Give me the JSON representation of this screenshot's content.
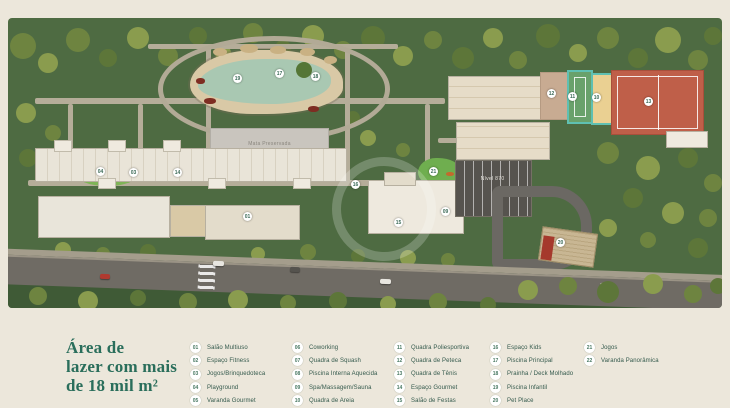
{
  "title": {
    "lines": [
      "Área de",
      "lazer com mais",
      "de 18 mil m²"
    ],
    "color": "#2a6e5b"
  },
  "map": {
    "labels": {
      "preserved_area": "Mata Preservada",
      "level": "Nível 870"
    },
    "markers": [
      {
        "num": "19",
        "x": 229,
        "y": 60
      },
      {
        "num": "17",
        "x": 271,
        "y": 55
      },
      {
        "num": "18",
        "x": 307,
        "y": 58
      },
      {
        "num": "12",
        "x": 543,
        "y": 75
      },
      {
        "num": "11",
        "x": 564,
        "y": 78
      },
      {
        "num": "10",
        "x": 588,
        "y": 79
      },
      {
        "num": "13",
        "x": 640,
        "y": 83
      },
      {
        "num": "04",
        "x": 92,
        "y": 153
      },
      {
        "num": "03",
        "x": 125,
        "y": 154
      },
      {
        "num": "14",
        "x": 169,
        "y": 154
      },
      {
        "num": "16",
        "x": 347,
        "y": 166
      },
      {
        "num": "21",
        "x": 425,
        "y": 153
      },
      {
        "num": "09",
        "x": 437,
        "y": 193
      },
      {
        "num": "15",
        "x": 390,
        "y": 204
      },
      {
        "num": "01",
        "x": 239,
        "y": 198
      },
      {
        "num": "20",
        "x": 552,
        "y": 224
      }
    ]
  },
  "legend": {
    "columns": [
      [
        {
          "num": "01",
          "label": "Salão Multiuso"
        },
        {
          "num": "02",
          "label": "Espaço Fitness"
        },
        {
          "num": "03",
          "label": "Jogos/Brinquedoteca"
        },
        {
          "num": "04",
          "label": "Playground"
        },
        {
          "num": "05",
          "label": "Varanda Gourmet"
        }
      ],
      [
        {
          "num": "06",
          "label": "Coworking"
        },
        {
          "num": "07",
          "label": "Quadra de Squash"
        },
        {
          "num": "08",
          "label": "Piscina Interna Aquecida"
        },
        {
          "num": "09",
          "label": "Spa/Massagem/Sauna"
        },
        {
          "num": "10",
          "label": "Quadra de Areia"
        }
      ],
      [
        {
          "num": "11",
          "label": "Quadra Poliesportiva"
        },
        {
          "num": "12",
          "label": "Quadra de Peteca"
        },
        {
          "num": "13",
          "label": "Quadra de Tênis"
        },
        {
          "num": "14",
          "label": "Espaço Gourmet"
        },
        {
          "num": "15",
          "label": "Salão de Festas"
        }
      ],
      [
        {
          "num": "16",
          "label": "Espaço Kids"
        },
        {
          "num": "17",
          "label": "Piscina Principal"
        },
        {
          "num": "18",
          "label": "Prainha / Deck Molhado"
        },
        {
          "num": "19",
          "label": "Piscina Infantil"
        },
        {
          "num": "20",
          "label": "Pet Place"
        }
      ],
      [
        {
          "num": "21",
          "label": "Jogos"
        },
        {
          "num": "22",
          "label": "Varanda Panorâmica"
        }
      ]
    ]
  }
}
